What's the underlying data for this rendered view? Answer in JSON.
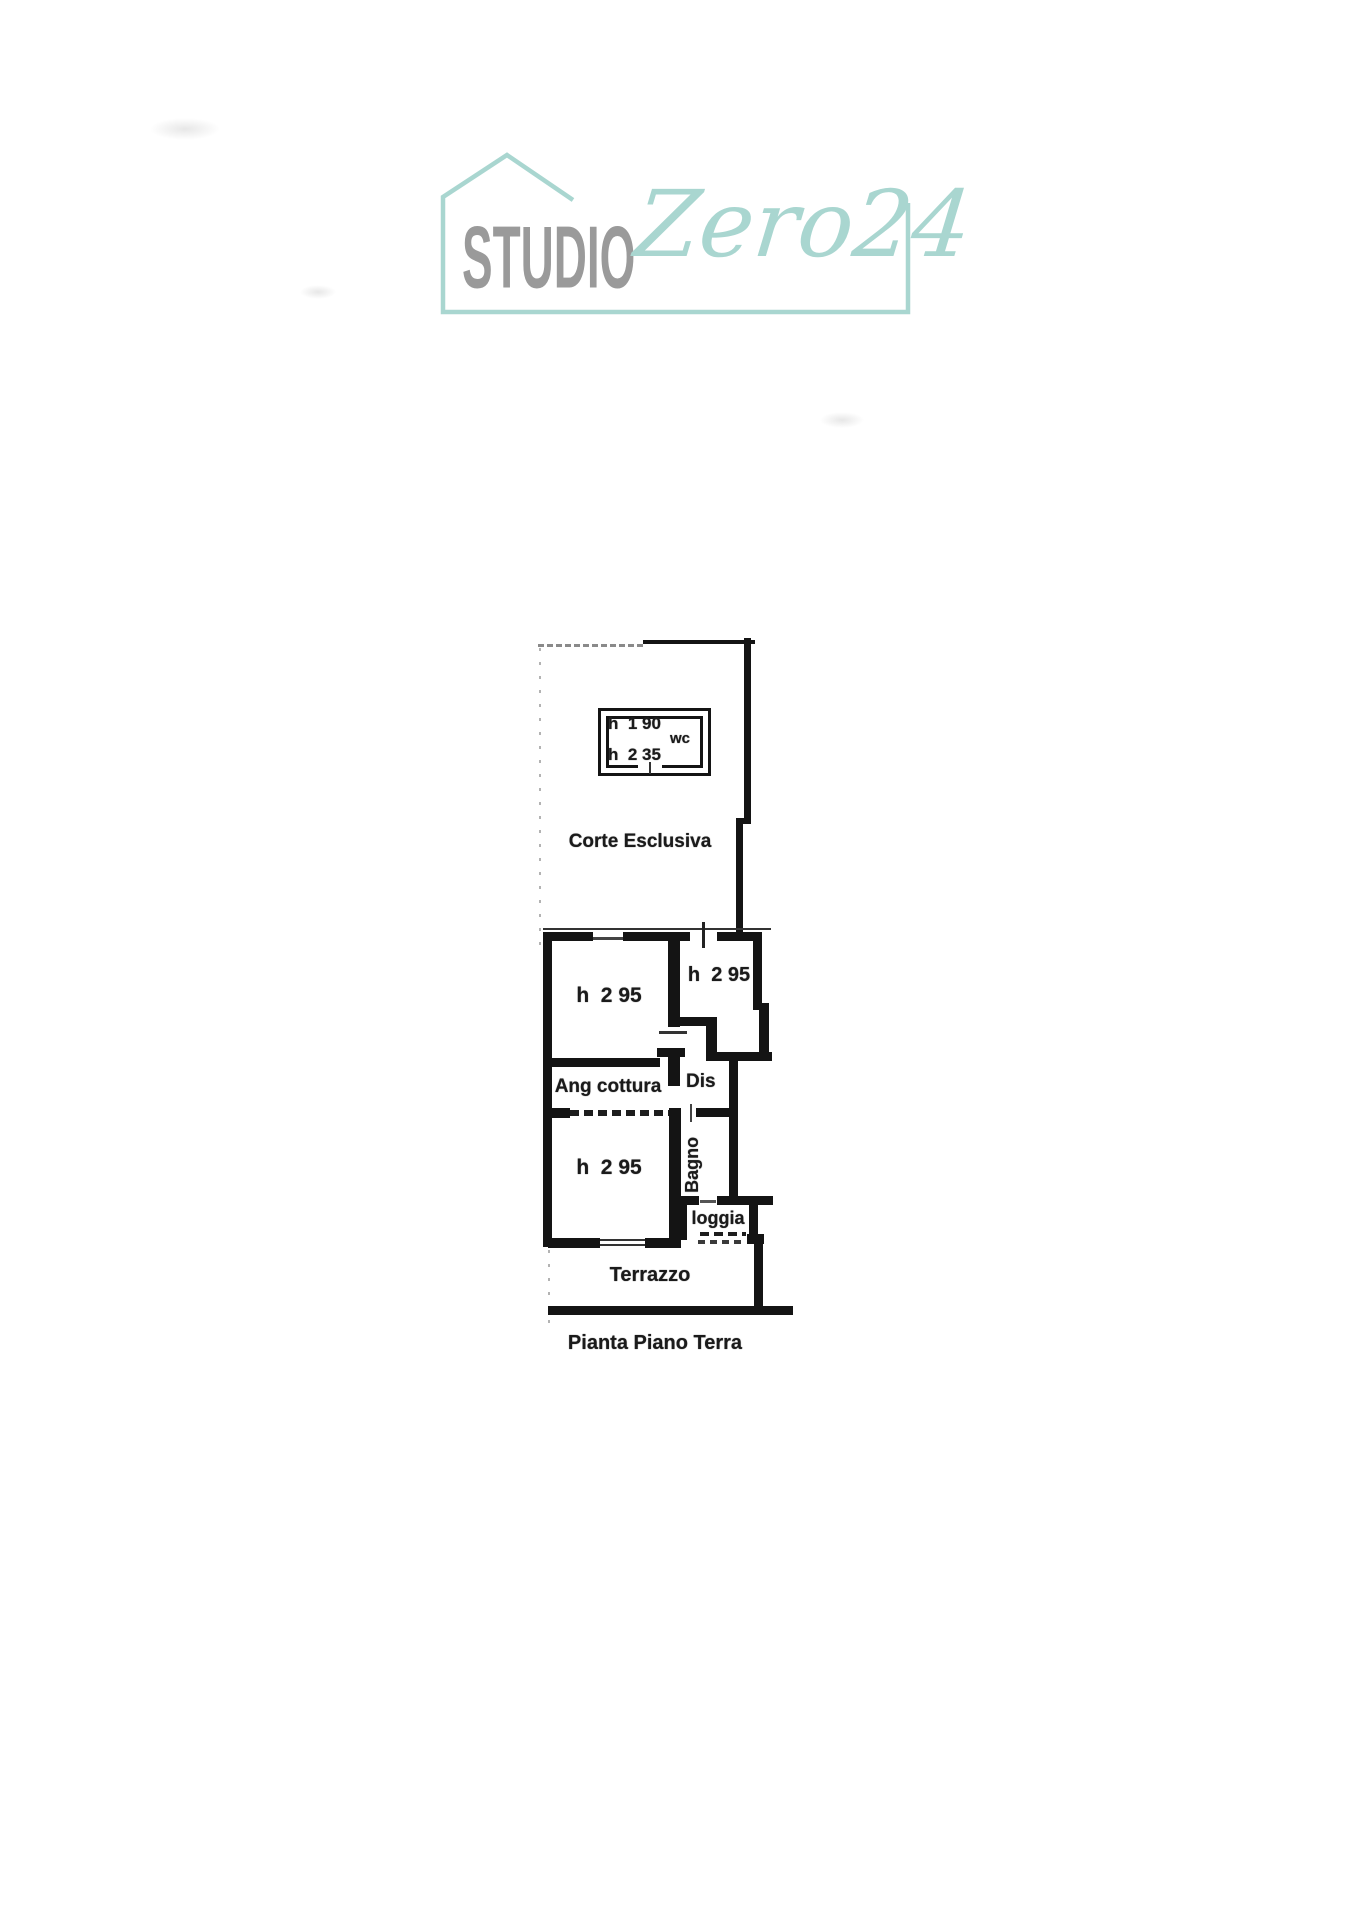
{
  "colors": {
    "teal": "#a9d6d0",
    "logo_gray": "#9a9a9a",
    "ink": "#161616"
  },
  "logo": {
    "name_left": "STUDIO",
    "name_right": "Zero24"
  },
  "plan": {
    "courtyard_label": "Corte Esclusiva",
    "wc": {
      "label": "wc",
      "height_upper": "h  1 90",
      "height_lower": "h  2 35"
    },
    "room_top_left_height": "h  2 95",
    "room_top_right_height": "h  2 95",
    "kitchen_label": "Ang cottura",
    "hall_label": "Dis",
    "room_bottom_height": "h  2 95",
    "bath_label": "Bagno",
    "loggia_label": "loggia",
    "terrace_label": "Terrazzo",
    "caption": "Pianta Piano Terra"
  }
}
